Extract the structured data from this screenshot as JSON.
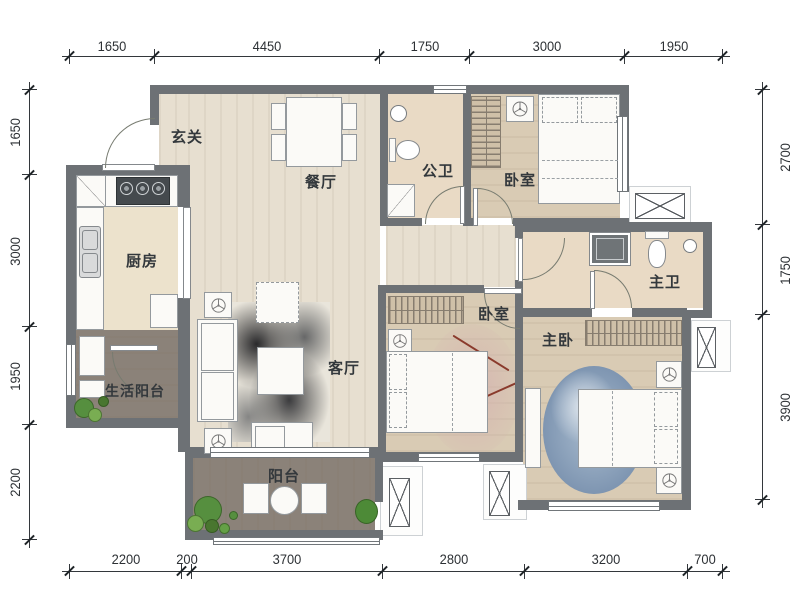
{
  "dims": {
    "top": [
      "1650",
      "4450",
      "1750",
      "3000",
      "1950"
    ],
    "bottom": [
      "2200",
      "200",
      "3700",
      "2800",
      "3200",
      "700"
    ],
    "left": [
      "1650",
      "3000",
      "1950",
      "2200"
    ],
    "right": [
      "2700",
      "1750",
      "3900"
    ]
  },
  "rooms": {
    "foyer": "玄关",
    "dining": "餐厅",
    "public_bath": "公卫",
    "bedroom_top": "卧室",
    "kitchen": "厨房",
    "living": "客厅",
    "bedroom_middle": "卧室",
    "master_bath": "主卫",
    "master_bedroom": "主卧",
    "service_balcony": "生活阳台",
    "balcony": "阳台"
  },
  "colors": {
    "wall": "#6d7175",
    "wood_light": "#e7dfd0",
    "wood_tan": "#d9cbb4",
    "tile": "#ece2cc",
    "bath_tile": "#e9dac5",
    "dark_wood": "#8b8279",
    "text": "#33383c",
    "plant_green": "#5f9a42",
    "rug_blue": "#8ea6bf",
    "rug_pink": "#d5b5b0",
    "ink_dark": "#1e2022"
  }
}
